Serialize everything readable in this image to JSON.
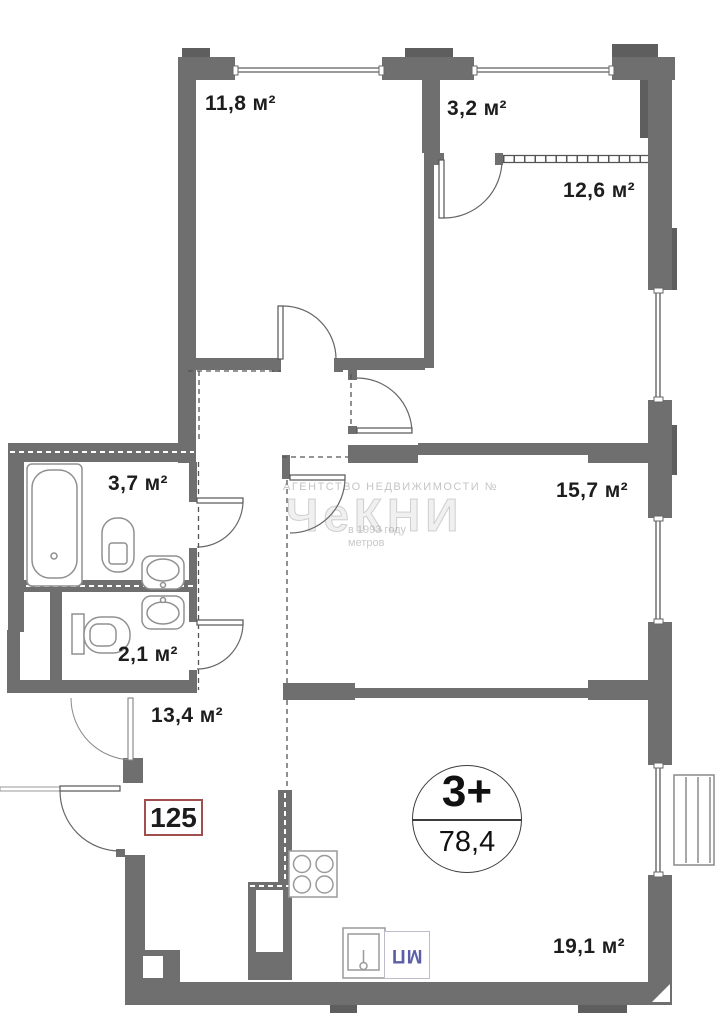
{
  "apartment": {
    "number": "125"
  },
  "badge": {
    "rooms": "3+",
    "total_area": "78,4"
  },
  "rooms": [
    {
      "name": "bedroom-top-left",
      "label": "11,8 м²"
    },
    {
      "name": "balcony",
      "label": "3,2 м²"
    },
    {
      "name": "bedroom-top-right",
      "label": "12,6 м²"
    },
    {
      "name": "bathroom",
      "label": "3,7 м²"
    },
    {
      "name": "bedroom-right",
      "label": "15,7 м²"
    },
    {
      "name": "wc",
      "label": "2,1 м²"
    },
    {
      "name": "hallway",
      "label": "13,4 м²"
    },
    {
      "name": "kitchen-living",
      "label": "19,1 м²"
    }
  ],
  "appliances": {
    "washing_machine_label": "МП"
  },
  "watermark": {
    "line1": "АГЕНТСТВО НЕДВИЖИМОСТИ №",
    "brand": "ЧеКНИ",
    "line3": "в 1993 году",
    "line4": "метров"
  },
  "colors": {
    "wall": "#6f6f6f",
    "accent_red": "#a04e4e",
    "washer_text": "#5c5fa8"
  }
}
